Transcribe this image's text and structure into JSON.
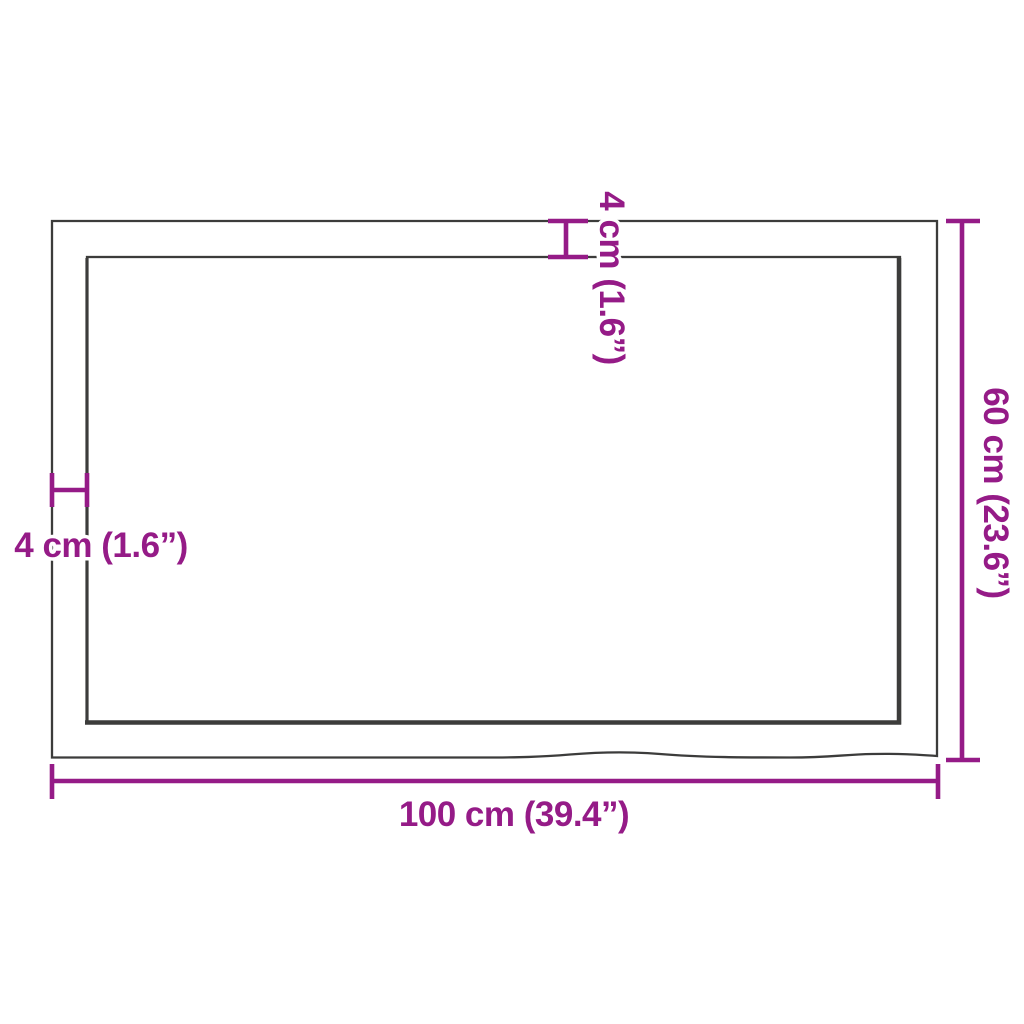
{
  "diagram": {
    "dimension_labels": {
      "width": "100 cm (39.4”)",
      "height": "60 cm (23.6”)",
      "thickness_top": "4 cm (1.6”)",
      "thickness_left": "4 cm (1.6”)"
    },
    "colors": {
      "dimension_accent": "#951B87",
      "outline": "#3C3C3B",
      "background": "#FFFFFF"
    }
  }
}
